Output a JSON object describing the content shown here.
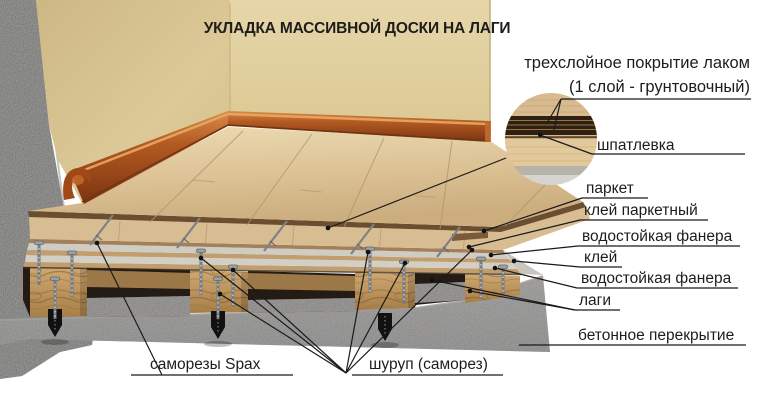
{
  "title": "УКЛАДКА МАССИВНОЙ ДОСКИ НА ЛАГИ",
  "callouts": {
    "coating_line1": "трехслойное покрытие лаком",
    "coating_line2": "(1 слой - грунтовочный)",
    "putty": "шпатлевка",
    "parquet": "паркет",
    "parquet_glue": "клей паркетный",
    "plywood_top": "водостойкая фанера",
    "glue": "клей",
    "plywood_bottom": "водостойкая фанера",
    "joists": "лаги",
    "concrete_slab": "бетонное перекрытие",
    "spax_screws": "саморезы Spax",
    "screw": "шуруп (саморез)"
  },
  "colors": {
    "background": "#ffffff",
    "wall": "#e0cf9f",
    "wall_shadow": "#c9b37e",
    "skirting": "#a8501c",
    "floor": "#dcc295",
    "lacquer_edge": "#6b4e2f",
    "plywood_band": "#d0cdc5",
    "glue_band": "#c29e6f",
    "joist_wood": "#c29a63",
    "concrete": "#7b7977",
    "concrete_cut": "#55534f",
    "anchor": "#111111",
    "text": "#1d1d1b"
  }
}
